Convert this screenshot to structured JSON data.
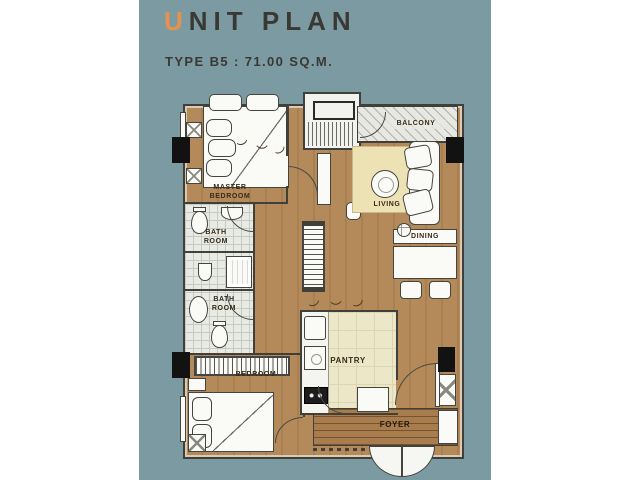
{
  "header": {
    "title_accent": "U",
    "title_rest": "NIT PLAN",
    "subtitle": "TYPE B5 : 71.00 SQ.M."
  },
  "plan": {
    "rooms": {
      "master_bedroom": "MASTER\nBEDROOM",
      "bath_room_1": "BATH\nROOM",
      "bath_room_2": "BATH\nROOM",
      "bedroom": "BEDROOM",
      "living": "LIVING",
      "dining": "DINING",
      "pantry": "PANTRY",
      "foyer": "FOYER",
      "balcony": "BALCONY"
    }
  },
  "colors": {
    "canvas": "#ffffff",
    "panel": "#7c9aa2",
    "title": "#3a3833",
    "accent": "#e8914d",
    "wall": "#403f39",
    "wood": "#b48a5a",
    "wood-dark": "#a87c4c",
    "rug": "#ece2b4",
    "pantry-floor": "#ebe7c8",
    "tile": "#e8eae4",
    "fixture": "#fafaf7",
    "column": "#121212",
    "label": "#3a2c18"
  }
}
